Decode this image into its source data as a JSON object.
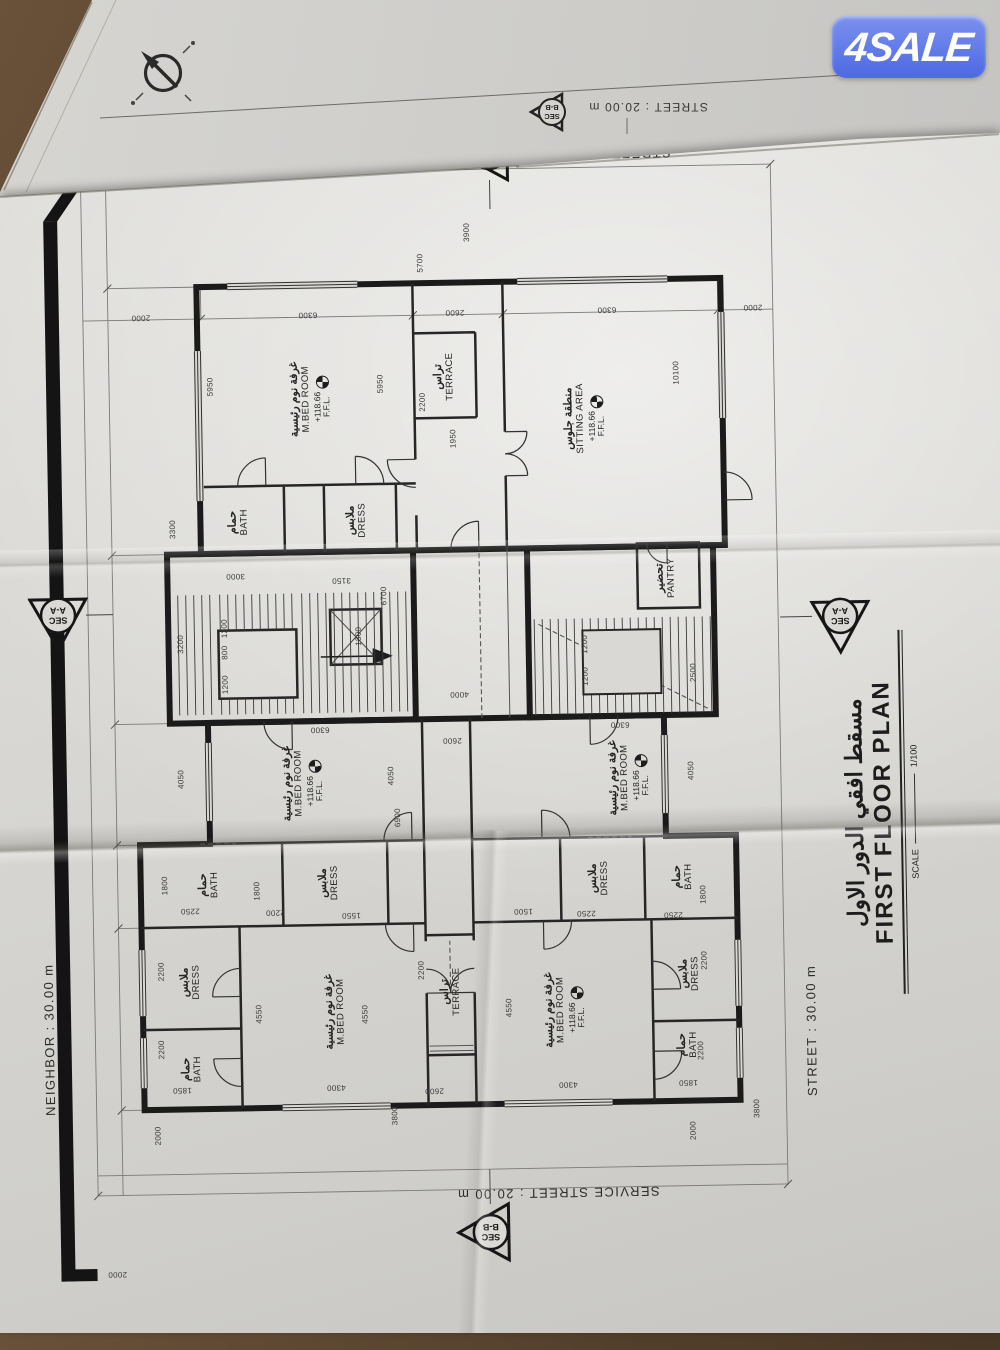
{
  "logo": {
    "text": "4SALE"
  },
  "back_sheet": {
    "street": "STREET : 20.00 m",
    "ffl_small": "F.F.L",
    "section": {
      "line1": "SEC",
      "line2": "B-B"
    }
  },
  "plan": {
    "streets": {
      "right": "STREET : 20.00 m",
      "service": "SERVICE STREET : 20.00 m",
      "neighbor": "NEIGHBOR : 30.00 m",
      "front": "STREET : 30.00 m"
    },
    "title": {
      "ar": "مسقط افقي الدور الاول",
      "en": "FIRST FLOOR PLAN",
      "scale_label": "SCALE",
      "scale_value": "1/100"
    },
    "section_aa": {
      "line1": "SEC",
      "line2": "A-A"
    },
    "section_bb": {
      "line1": "SEC",
      "line2": "B-B"
    },
    "ffl": {
      "value": "+118.66",
      "label": "F.F.L."
    },
    "rooms": [
      {
        "id": "mbed-a",
        "ar": "غرفة نوم رئيسية",
        "en": "M.BED ROOM",
        "x": 285,
        "y": 300,
        "ffl": false
      },
      {
        "id": "bed2-a",
        "ar": "غرفة نوم رئيسية",
        "en": "M.BED ROOM",
        "x": 514,
        "y": 272,
        "ffl": true
      },
      {
        "id": "bath-a1",
        "ar": "حمام",
        "en": "BATH",
        "x": 230,
        "y": 156,
        "ffl": false
      },
      {
        "id": "dress-a1",
        "ar": "ملابس",
        "en": "DRESS",
        "x": 317,
        "y": 156,
        "ffl": false
      },
      {
        "id": "bath-a2",
        "ar": "حمام",
        "en": "BATH",
        "x": 414,
        "y": 176,
        "ffl": false
      },
      {
        "id": "dress-a2",
        "ar": "ملابس",
        "en": "DRESS",
        "x": 414,
        "y": 296,
        "ffl": false
      },
      {
        "id": "mbed-b",
        "ar": "غرفة نوم رئيسية",
        "en": "M.BED ROOM",
        "x": 283,
        "y": 530,
        "ffl": true
      },
      {
        "id": "bed2-b",
        "ar": "غرفة نوم رئيسية",
        "en": "M.BED ROOM",
        "x": 514,
        "y": 598,
        "ffl": true
      },
      {
        "id": "dress-b2",
        "ar": "ملابس",
        "en": "DRESS",
        "x": 414,
        "y": 566,
        "ffl": false
      },
      {
        "id": "bath-b2",
        "ar": "حمام",
        "en": "BATH",
        "x": 414,
        "y": 650,
        "ffl": false
      },
      {
        "id": "dress-b1",
        "ar": "ملابس",
        "en": "DRESS",
        "x": 317,
        "y": 655,
        "ffl": false
      },
      {
        "id": "bath-b1",
        "ar": "حمام",
        "en": "BATH",
        "x": 246,
        "y": 652,
        "ffl": false
      },
      {
        "id": "terrace-m",
        "ar": "تراس",
        "en": "TERRACE",
        "x": 303,
        "y": 416,
        "ffl": false
      },
      {
        "id": "mbed-c",
        "ar": "غرفة نوم رئيسية",
        "en": "M.BED ROOM",
        "x": 898,
        "y": 286,
        "ffl": true
      },
      {
        "id": "terrace-c",
        "ar": "تراس",
        "en": "TERRACE",
        "x": 918,
        "y": 420,
        "ffl": false
      },
      {
        "id": "bath-c",
        "ar": "حمام",
        "en": "BATH",
        "x": 776,
        "y": 212,
        "ffl": false
      },
      {
        "id": "dress-c",
        "ar": "ملابس",
        "en": "DRESS",
        "x": 776,
        "y": 330,
        "ffl": false
      },
      {
        "id": "sitting",
        "ar": "منطقة جلوس",
        "en": "SITTING AREA",
        "x": 874,
        "y": 560,
        "ffl": true
      },
      {
        "id": "pantry",
        "ar": "تحضير",
        "en": "PANTRY",
        "x": 713,
        "y": 638,
        "ffl": false
      }
    ],
    "dims": [
      {
        "t": "2000",
        "x": 982,
        "y": 118,
        "o": "v"
      },
      {
        "t": "6300",
        "x": 982,
        "y": 285,
        "o": "v"
      },
      {
        "t": "2600",
        "x": 982,
        "y": 432,
        "o": "v"
      },
      {
        "t": "6300",
        "x": 982,
        "y": 584,
        "o": "v"
      },
      {
        "t": "2000",
        "x": 982,
        "y": 730,
        "o": "v"
      },
      {
        "t": "3900",
        "x": 1062,
        "y": 445,
        "o": "h"
      },
      {
        "t": "5700",
        "x": 1032,
        "y": 398,
        "o": "h"
      },
      {
        "t": "5950",
        "x": 912,
        "y": 186,
        "o": "h"
      },
      {
        "t": "5950",
        "x": 912,
        "y": 356,
        "o": "h"
      },
      {
        "t": "2200",
        "x": 893,
        "y": 398,
        "o": "h"
      },
      {
        "t": "1950",
        "x": 856,
        "y": 428,
        "o": "h"
      },
      {
        "t": "3300",
        "x": 770,
        "y": 146,
        "o": "h"
      },
      {
        "t": "3000",
        "x": 722,
        "y": 208,
        "o": "v"
      },
      {
        "t": "3150",
        "x": 716,
        "y": 314,
        "o": "v"
      },
      {
        "t": "6700",
        "x": 700,
        "y": 356,
        "o": "h"
      },
      {
        "t": "10100",
        "x": 918,
        "y": 652,
        "o": "h"
      },
      {
        "t": "2500",
        "x": 618,
        "y": 664,
        "o": "h"
      },
      {
        "t": "3200",
        "x": 655,
        "y": 152,
        "o": "h"
      },
      {
        "t": "1200",
        "x": 670,
        "y": 196,
        "o": "h"
      },
      {
        "t": "800",
        "x": 646,
        "y": 196,
        "o": "h"
      },
      {
        "t": "1200",
        "x": 614,
        "y": 196,
        "o": "h"
      },
      {
        "t": "1800",
        "x": 660,
        "y": 330,
        "o": "h"
      },
      {
        "t": "1200",
        "x": 648,
        "y": 556,
        "o": "h"
      },
      {
        "t": "1200",
        "x": 616,
        "y": 556,
        "o": "h"
      },
      {
        "t": "4000",
        "x": 600,
        "y": 430,
        "o": "v"
      },
      {
        "t": "2600",
        "x": 554,
        "y": 422,
        "o": "v"
      },
      {
        "t": "6300",
        "x": 567,
        "y": 290,
        "o": "v"
      },
      {
        "t": "6300",
        "x": 567,
        "y": 590,
        "o": "v"
      },
      {
        "t": "6900",
        "x": 478,
        "y": 366,
        "o": "h"
      },
      {
        "t": "4050",
        "x": 520,
        "y": 150,
        "o": "h"
      },
      {
        "t": "4050",
        "x": 520,
        "y": 360,
        "o": "h"
      },
      {
        "t": "4050",
        "x": 520,
        "y": 660,
        "o": "h"
      },
      {
        "t": "1800",
        "x": 414,
        "y": 132,
        "o": "h"
      },
      {
        "t": "2250",
        "x": 388,
        "y": 157,
        "o": "v"
      },
      {
        "t": "1800",
        "x": 407,
        "y": 224,
        "o": "h"
      },
      {
        "t": "2200",
        "x": 385,
        "y": 242,
        "o": "v"
      },
      {
        "t": "1550",
        "x": 381,
        "y": 318,
        "o": "v"
      },
      {
        "t": "4550",
        "x": 284,
        "y": 224,
        "o": "h"
      },
      {
        "t": "4550",
        "x": 282,
        "y": 330,
        "o": "h"
      },
      {
        "t": "4300",
        "x": 209,
        "y": 300,
        "o": "v"
      },
      {
        "t": "2200",
        "x": 328,
        "y": 127,
        "o": "h"
      },
      {
        "t": "2200",
        "x": 250,
        "y": 126,
        "o": "h"
      },
      {
        "t": "1850",
        "x": 209,
        "y": 146,
        "o": "v"
      },
      {
        "t": "2000",
        "x": 164,
        "y": 121,
        "o": "h"
      },
      {
        "t": "3800",
        "x": 180,
        "y": 358,
        "o": "h"
      },
      {
        "t": "2200",
        "x": 325,
        "y": 387,
        "o": "h"
      },
      {
        "t": "2600",
        "x": 204,
        "y": 398,
        "o": "v"
      },
      {
        "t": "1500",
        "x": 382,
        "y": 490,
        "o": "v"
      },
      {
        "t": "2250",
        "x": 379,
        "y": 553,
        "o": "v"
      },
      {
        "t": "2250",
        "x": 376,
        "y": 640,
        "o": "v"
      },
      {
        "t": "1800",
        "x": 396,
        "y": 670,
        "o": "h"
      },
      {
        "t": "4550",
        "x": 286,
        "y": 474,
        "o": "h"
      },
      {
        "t": "4300",
        "x": 208,
        "y": 532,
        "o": "v"
      },
      {
        "t": "2200",
        "x": 330,
        "y": 670,
        "o": "h"
      },
      {
        "t": "2200",
        "x": 240,
        "y": 665,
        "o": "h"
      },
      {
        "t": "1850",
        "x": 208,
        "y": 652,
        "o": "v"
      },
      {
        "t": "2000",
        "x": 160,
        "y": 656,
        "o": "h"
      },
      {
        "t": "3800",
        "x": 181,
        "y": 720,
        "o": "h"
      },
      {
        "t": "2000",
        "x": 26,
        "y": 78,
        "o": "v"
      }
    ]
  }
}
